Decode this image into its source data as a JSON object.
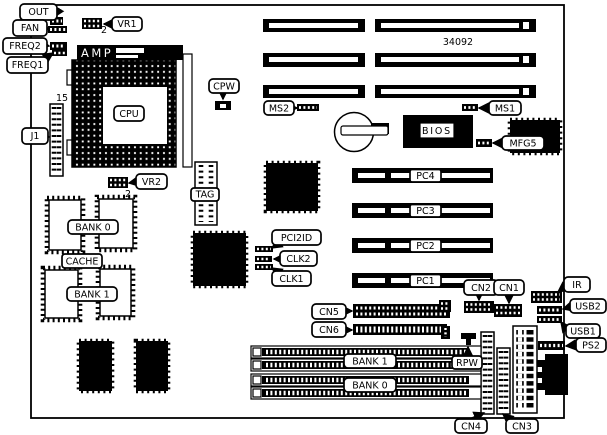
{
  "board": {
    "callouts": {
      "out": "OUT",
      "fan": "FAN",
      "freq2": "FREQ2",
      "freq1": "FREQ1",
      "vr1": "VR1",
      "j1": "J1",
      "vr2": "VR2",
      "cpw": "CPW",
      "ms2": "MS2",
      "ms1": "MS1",
      "mfg5": "MFG5",
      "pci2id": "PCI2ID",
      "clk2": "CLK2",
      "clk1": "CLK1",
      "cn5": "CN5",
      "cn6": "CN6",
      "cn2": "CN2",
      "cn1": "CN1",
      "ir": "IR",
      "usb2": "USB2",
      "usb1": "USB1",
      "ps2": "PS2",
      "rpw": "RPW",
      "cn4": "CN4",
      "cn3": "CN3"
    },
    "chips": {
      "cpu": "CPU",
      "amp": "AMP",
      "bios": "BIOS",
      "tag": "TAG",
      "cache": "CACHE",
      "cache_bank0": "BANK 0",
      "cache_bank1": "BANK 1"
    },
    "slots": {
      "pc4": "PC4",
      "pc3": "PC3",
      "pc2": "PC2",
      "pc1": "PC1",
      "simm_bank1": "BANK 1",
      "simm_bank0": "BANK 0"
    },
    "annotations": {
      "part_number": "34092",
      "j1_pin_count": "15",
      "vr1_pin": "2",
      "vr2_pin": "2"
    }
  }
}
